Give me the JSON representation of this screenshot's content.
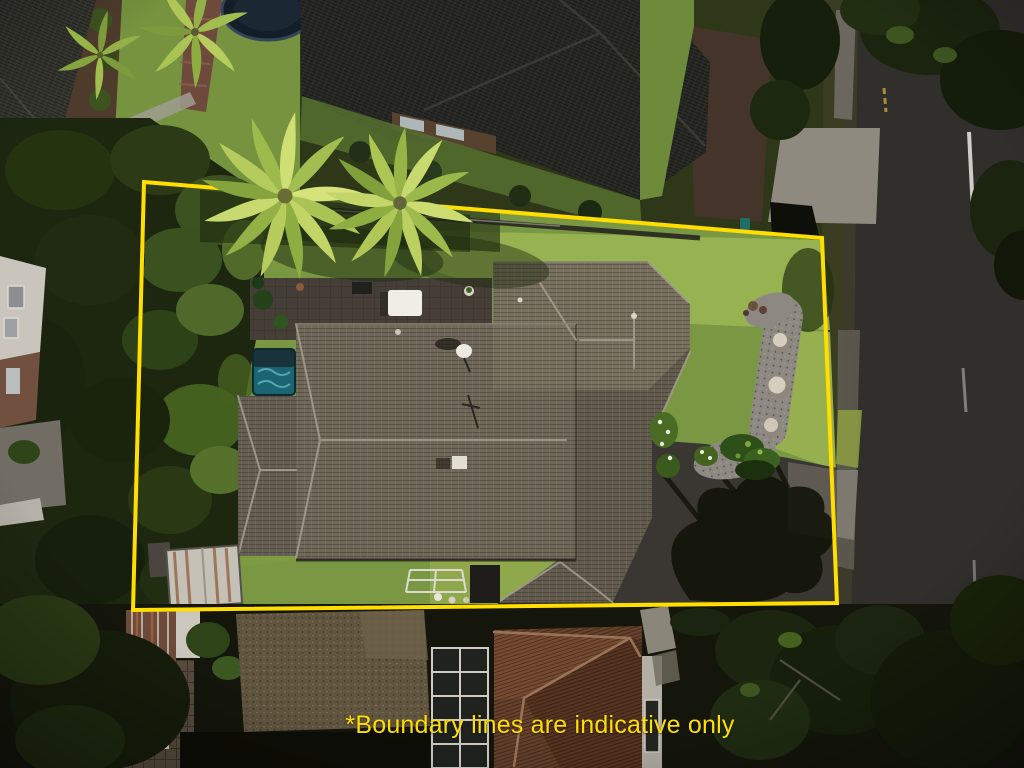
{
  "overlay": {
    "disclaimer_text": "*Boundary lines are indicative only",
    "boundary_color": "#FFDE00",
    "text_color": "#FFDE00"
  },
  "scene": {
    "type": "aerial-drone-photo-of-residential-property",
    "property": {
      "boundary_points": "144,182 822,238 837,603 133,610",
      "features": [
        "main-house-grey-tiled-hip-roof",
        "back-patio-with-white-table",
        "spa-pool",
        "palm-trees",
        "front-lawn",
        "pebble-garden-with-stone-spheres",
        "asphalt-driveway-with-tree-shadow",
        "garden-shed",
        "dense-trees-along-west-boundary",
        "satellite-dish",
        "white-stair-railing"
      ]
    },
    "surroundings": [
      "neighbour-house-north-dark-roof",
      "trampoline-north",
      "brick-garden-path-northwest",
      "street-east-with-centre-line",
      "concrete-driveway-apron-northeast",
      "footpath-and-grass-verge",
      "neighbour-terracotta-roof-south",
      "pebble-flat-roof-south",
      "conservatory-glass-roof-south",
      "street-trees"
    ]
  },
  "palette": {
    "boundary_yellow": "#FFDE00",
    "lawn_green": "#7A9843",
    "lawn_sunlit": "#99B452",
    "tree_dark": "#1D2710",
    "tree_light": "#4E6929",
    "palm_bright": "#D6E37A",
    "palm_mid": "#A9C354",
    "roof_main_grey": "#6F6859",
    "roof_neighbour_north": "#282925",
    "roof_terracotta": "#66412B",
    "road_asphalt": "#312F2C",
    "concrete": "#8F8A80",
    "spa_teal": "#1B6572",
    "shadow": "#101207"
  }
}
